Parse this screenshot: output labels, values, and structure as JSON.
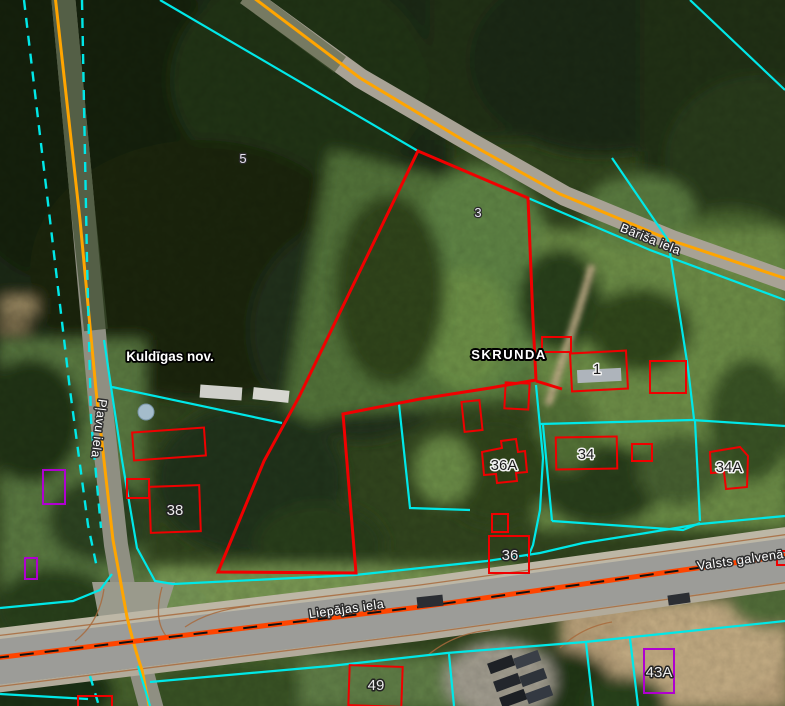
{
  "map": {
    "kind": "cadastral parcel map over aerial imagery",
    "municipality_label": "Kuldīgas nov.",
    "town_label": "SKRUNDA",
    "streets": {
      "plavu": "Pļavu iela",
      "barisa": "Bāriša iela",
      "liepajas": "Liepājas iela",
      "valsts": "Valsts galvenā"
    },
    "parcel_numbers": {
      "p5": "5",
      "p3": "3"
    },
    "address_numbers": {
      "a1": "1",
      "a34": "34",
      "a34a": "34A",
      "a36": "36",
      "a36a": "36A",
      "a38": "38",
      "a43a": "43A",
      "a49": "49"
    },
    "colors": {
      "cadastre_boundary": "#00e8e8",
      "highlighted_parcel": "#f00000",
      "minor_road_centerline": "#ffa500",
      "main_road_centerline": "#ff4500",
      "special_zone": "#b000d0"
    }
  }
}
